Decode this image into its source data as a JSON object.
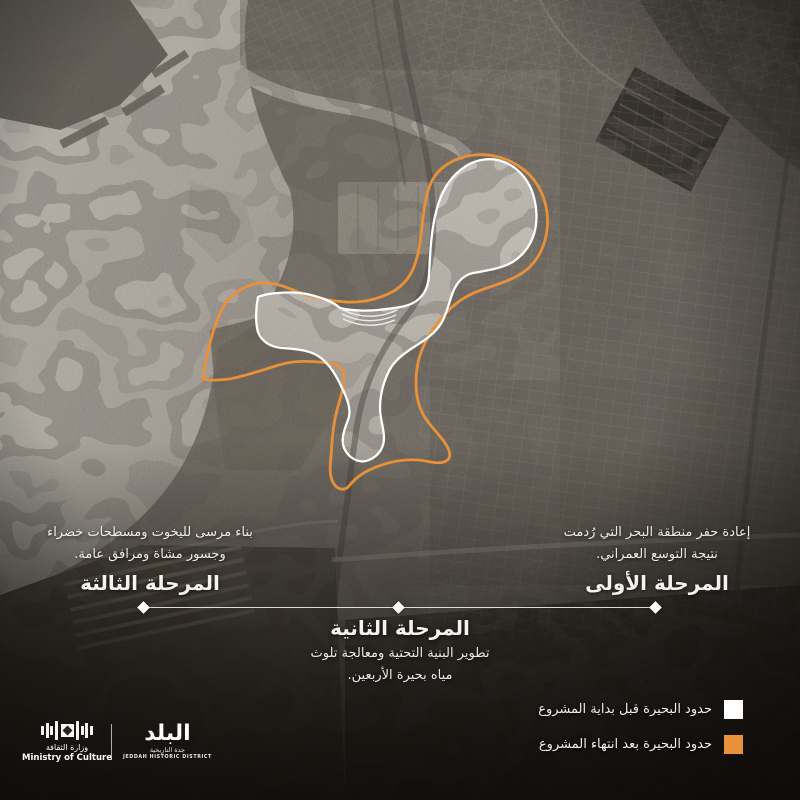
{
  "poster": {
    "phases": [
      {
        "id": "phase-1",
        "title": "المرحلة الأولى",
        "lines": [
          "إعادة حفر منطقة البحر التي رُدمت",
          "نتيجة التوسع العمراني."
        ]
      },
      {
        "id": "phase-2",
        "title": "المرحلة الثانية",
        "lines": [
          "تطوير البنية التحتية ومعالجة تلوث",
          "مياه بحيرة الأربعين."
        ]
      },
      {
        "id": "phase-3",
        "title": "المرحلة الثالثة",
        "lines": [
          "بناء مرسى لليخوت ومسطحات خضراء",
          "وجسور مشاة ومرافق عامة."
        ]
      }
    ],
    "legend": {
      "items": [
        {
          "label": "حدود البحيرة قبل بداية المشروع",
          "color": "#ffffff"
        },
        {
          "label": "حدود البحيرة بعد انتهاء المشروع",
          "color": "#e8913a"
        }
      ]
    },
    "logos": {
      "ministry": {
        "name_ar": "وزارة الثقافة",
        "name_en": "Ministry of Culture"
      },
      "district": {
        "wordmark": "البلد",
        "sub_ar": "جدة التاريخية",
        "sub_en": "JEDDAH HISTORIC DISTRICT"
      }
    },
    "colors": {
      "boundary_before": "#ffffff",
      "boundary_after": "#e8913a",
      "timeline": "#faf8f4",
      "basemap_tone": "#6e6962"
    }
  }
}
